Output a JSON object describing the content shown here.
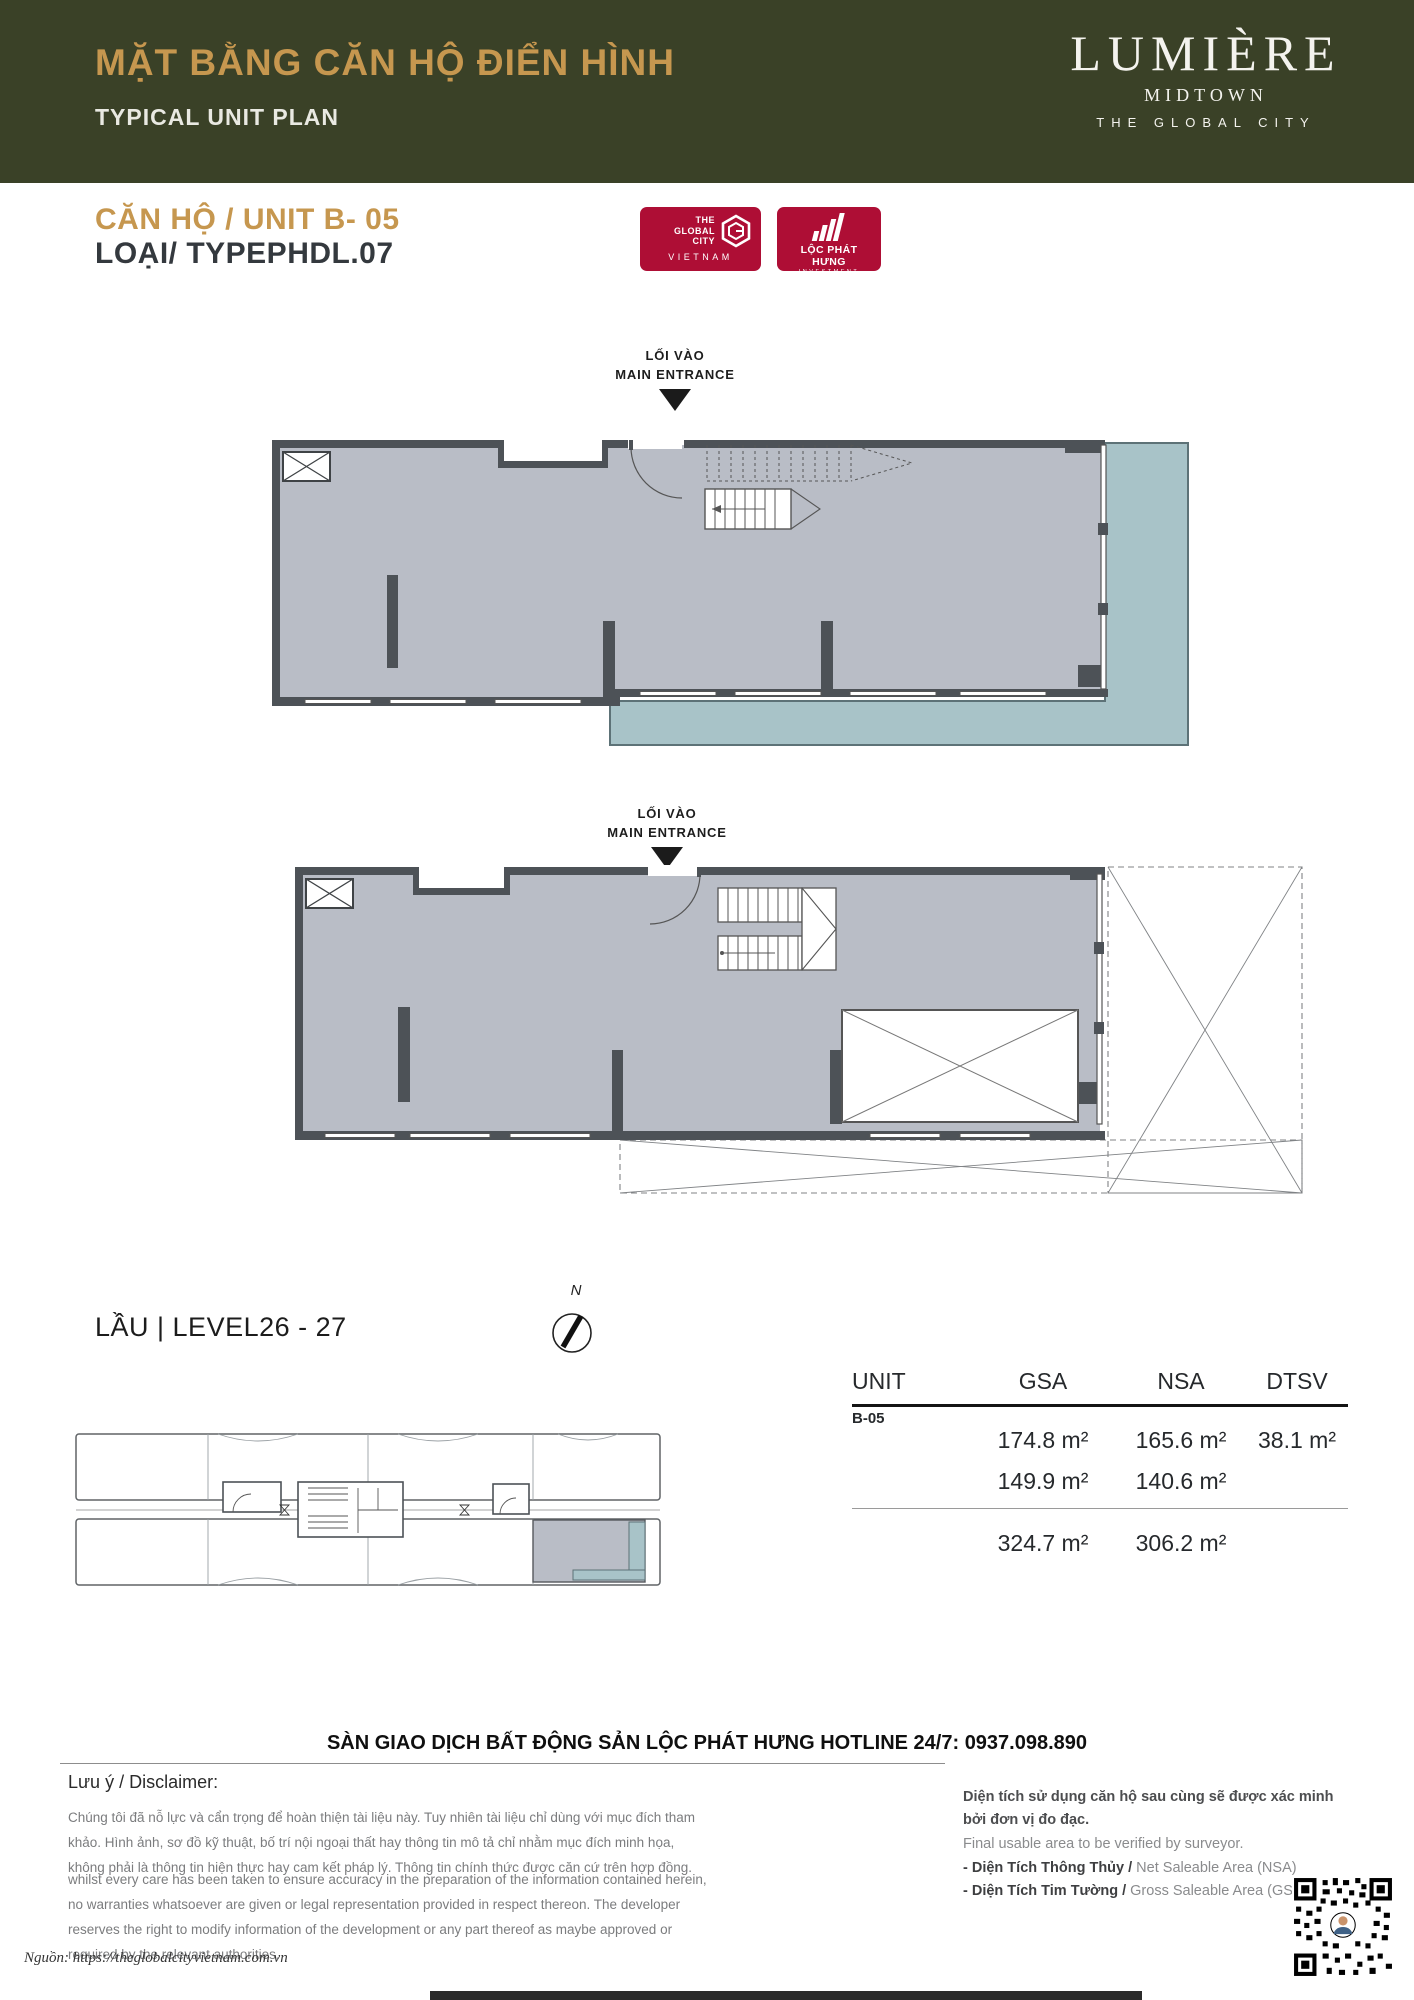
{
  "header": {
    "title_vi": "MẶT BẰNG CĂN HỘ ĐIỂN HÌNH",
    "title_en": "TYPICAL UNIT PLAN",
    "brand_name": "LUMIÈRE",
    "brand_sub": "MIDTOWN",
    "brand_tagline": "THE GLOBAL CITY",
    "bg_color": "#3a4127",
    "accent_color": "#c6974f"
  },
  "unit_info": {
    "unit_line": "CĂN HỘ / UNIT B- 05",
    "type_line": "LOẠI/ TYPEPHDL.07"
  },
  "logos": {
    "brand_color": "#ae0e35",
    "global_city": {
      "line1": "THE",
      "line2": "GLOBAL",
      "line3": "CITY",
      "country": "VIETNAM"
    },
    "loc_phat_hung": {
      "name": "LỘC PHÁT HƯNG",
      "sub": "INVESTMENT"
    }
  },
  "entrance": {
    "vi": "LỐI VÀO",
    "en": "MAIN ENTRANCE"
  },
  "level_label": "LẦU | LEVEL26 - 27",
  "compass": {
    "north": "N"
  },
  "area_table": {
    "headers": {
      "unit": "UNIT",
      "gsa": "GSA",
      "nsa": "NSA",
      "dtsv": "DTSV"
    },
    "unit_id": "B-05",
    "rows": [
      {
        "gsa": "174.8 m²",
        "nsa": "165.6 m²",
        "dtsv": "38.1 m²"
      },
      {
        "gsa": "149.9 m²",
        "nsa": "140.6 m²",
        "dtsv": ""
      },
      {
        "gsa": "324.7 m²",
        "nsa": "306.2 m²",
        "dtsv": ""
      }
    ]
  },
  "hotline": "SÀN GIAO DỊCH BẤT ĐỘNG SẢN LỘC PHÁT HƯNG HOTLINE 24/7: 0937.098.890",
  "disclaimer": {
    "heading": "Lưu ý / Disclaimer:",
    "vi": "Chúng tôi đã nỗ lực và cẩn trọng để hoàn thiện tài liệu này. Tuy nhiên tài liệu chỉ dùng với mục đích tham khảo. Hình ảnh, sơ đồ kỹ thuật, bố trí nội ngoại thất hay thông tin mô tả chỉ nhằm mục đích minh họa, không phải là thông tin hiện thực hay cam kết pháp lý. Thông tin chính thức được căn cứ trên hợp đồng.",
    "en": "whilst every care has been taken to ensure accuracy in the preparation of the information contained herein, no warranties whatsoever are given or legal representation provided in respect thereon. The developer reserves the right to modify information of the development or any part thereof as maybe approved or required by the relevant authorities."
  },
  "area_notes": {
    "vi_bold": "Diện tích sử dụng căn hộ sau cùng sẽ được xác minh bởi đơn vị đo đạc.",
    "en": "Final usable area to be verified by surveyor.",
    "nsa_vi": "- Diện Tích Thông Thủy /",
    "nsa_en": " Net Saleable Area (NSA)",
    "gsa_vi": "- Diện Tích Tim Tường /",
    "gsa_en": " Gross Saleable Area (GSA)"
  },
  "source": "Nguồn: https://theglobalcityvietnam.com.vn"
}
